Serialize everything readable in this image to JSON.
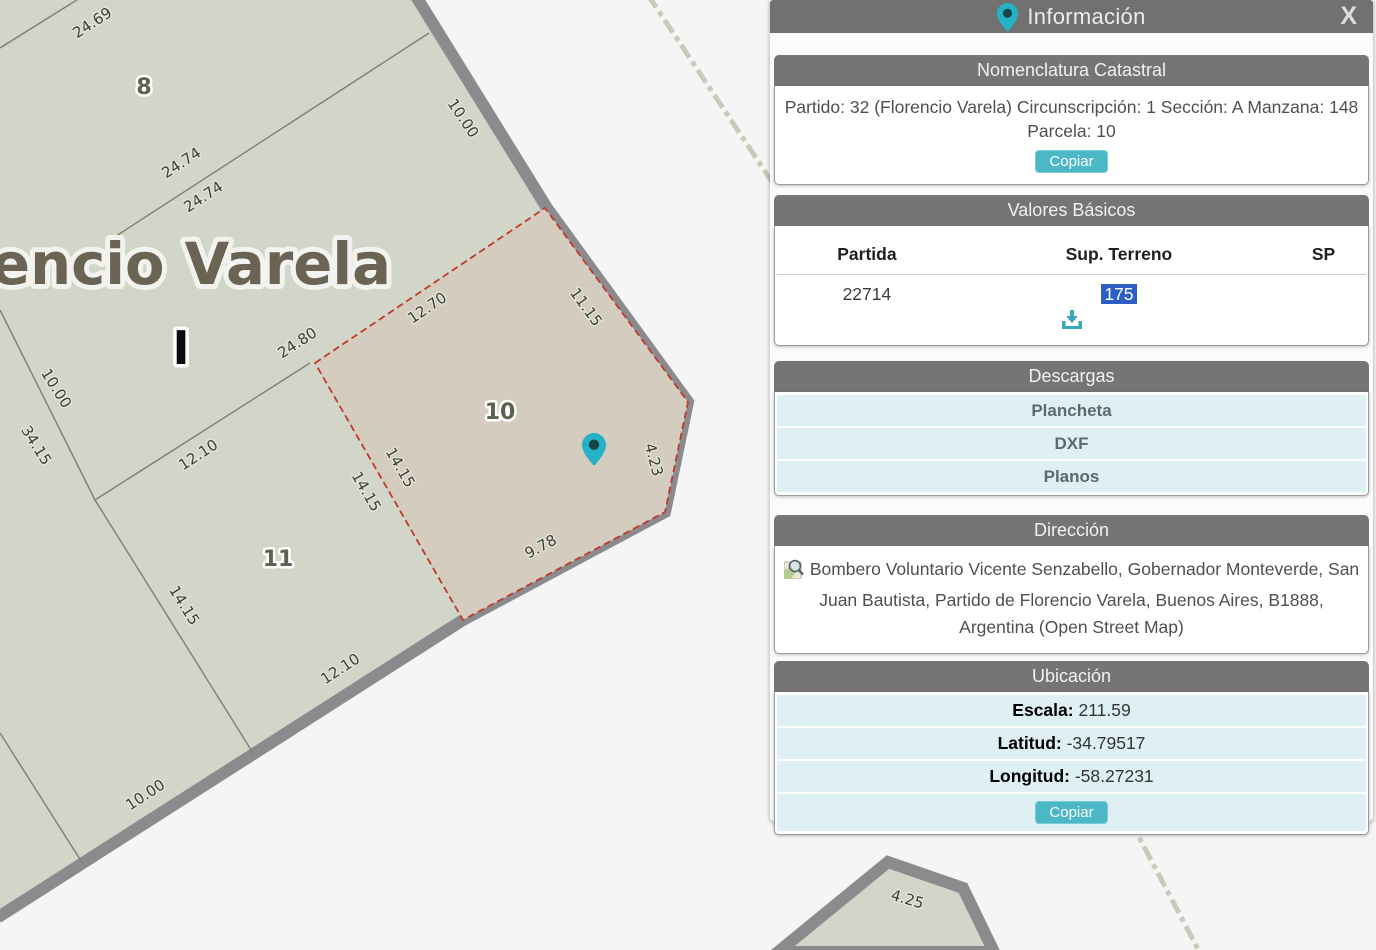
{
  "panel": {
    "title": "Información",
    "title_icon": "map-pin-icon",
    "close_label": "X",
    "nomenclatura": {
      "title": "Nomenclatura Catastral",
      "text": "Partido: 32 (Florencio Varela) Circunscripción: 1 Sección: A Manzana: 148 Parcela: 10",
      "copy_label": "Copiar"
    },
    "valores": {
      "title": "Valores Básicos",
      "columns": [
        "Partida",
        "Sup. Terreno",
        "SP"
      ],
      "row": {
        "partida": "22714",
        "sup_terreno": "175",
        "sp": ""
      },
      "download_icon": "download-tray-icon"
    },
    "descargas": {
      "title": "Descargas",
      "items": [
        "Plancheta",
        "DXF",
        "Planos"
      ]
    },
    "direccion": {
      "title": "Dirección",
      "icon": "map-magnifier-icon",
      "text": "Bombero Voluntario Vicente Senzabello, Gobernador Monteverde, San Juan Bautista, Partido de Florencio Varela, Buenos Aires, B1888, Argentina (Open Street Map)"
    },
    "ubicacion": {
      "title": "Ubicación",
      "rows": [
        {
          "label": "Escala:",
          "value": "211.59"
        },
        {
          "label": "Latitud:",
          "value": "-34.79517"
        },
        {
          "label": "Longitud:",
          "value": "-58.27231"
        }
      ],
      "copy_label": "Copiar"
    }
  },
  "map": {
    "region_title": "encio Varela",
    "section_marker": "I",
    "parcel_numbers": [
      "8",
      "10",
      "11"
    ],
    "dimension_labels": [
      "24.69",
      "10.00",
      "24.74",
      "24.74",
      "12.70",
      "11.15",
      "24.80",
      "12.10",
      "14.15",
      "14.15",
      "4.23",
      "9.78",
      "12.10",
      "14.15",
      "34.15",
      "10.00",
      "10.00",
      "4.25"
    ],
    "pin_icon": "map-pin-icon",
    "colors": {
      "block_fill": "#d2d6c8",
      "selected_parcel_fill": "#d5ccc0",
      "block_border": "#8b8b8e",
      "selected_parcel_border": "#c0392b",
      "pin_teal": "#25b2c6",
      "accent_teal": "#4cb8c7",
      "selection_blue": "#2c5ec6",
      "bar_gray": "#757575"
    }
  }
}
